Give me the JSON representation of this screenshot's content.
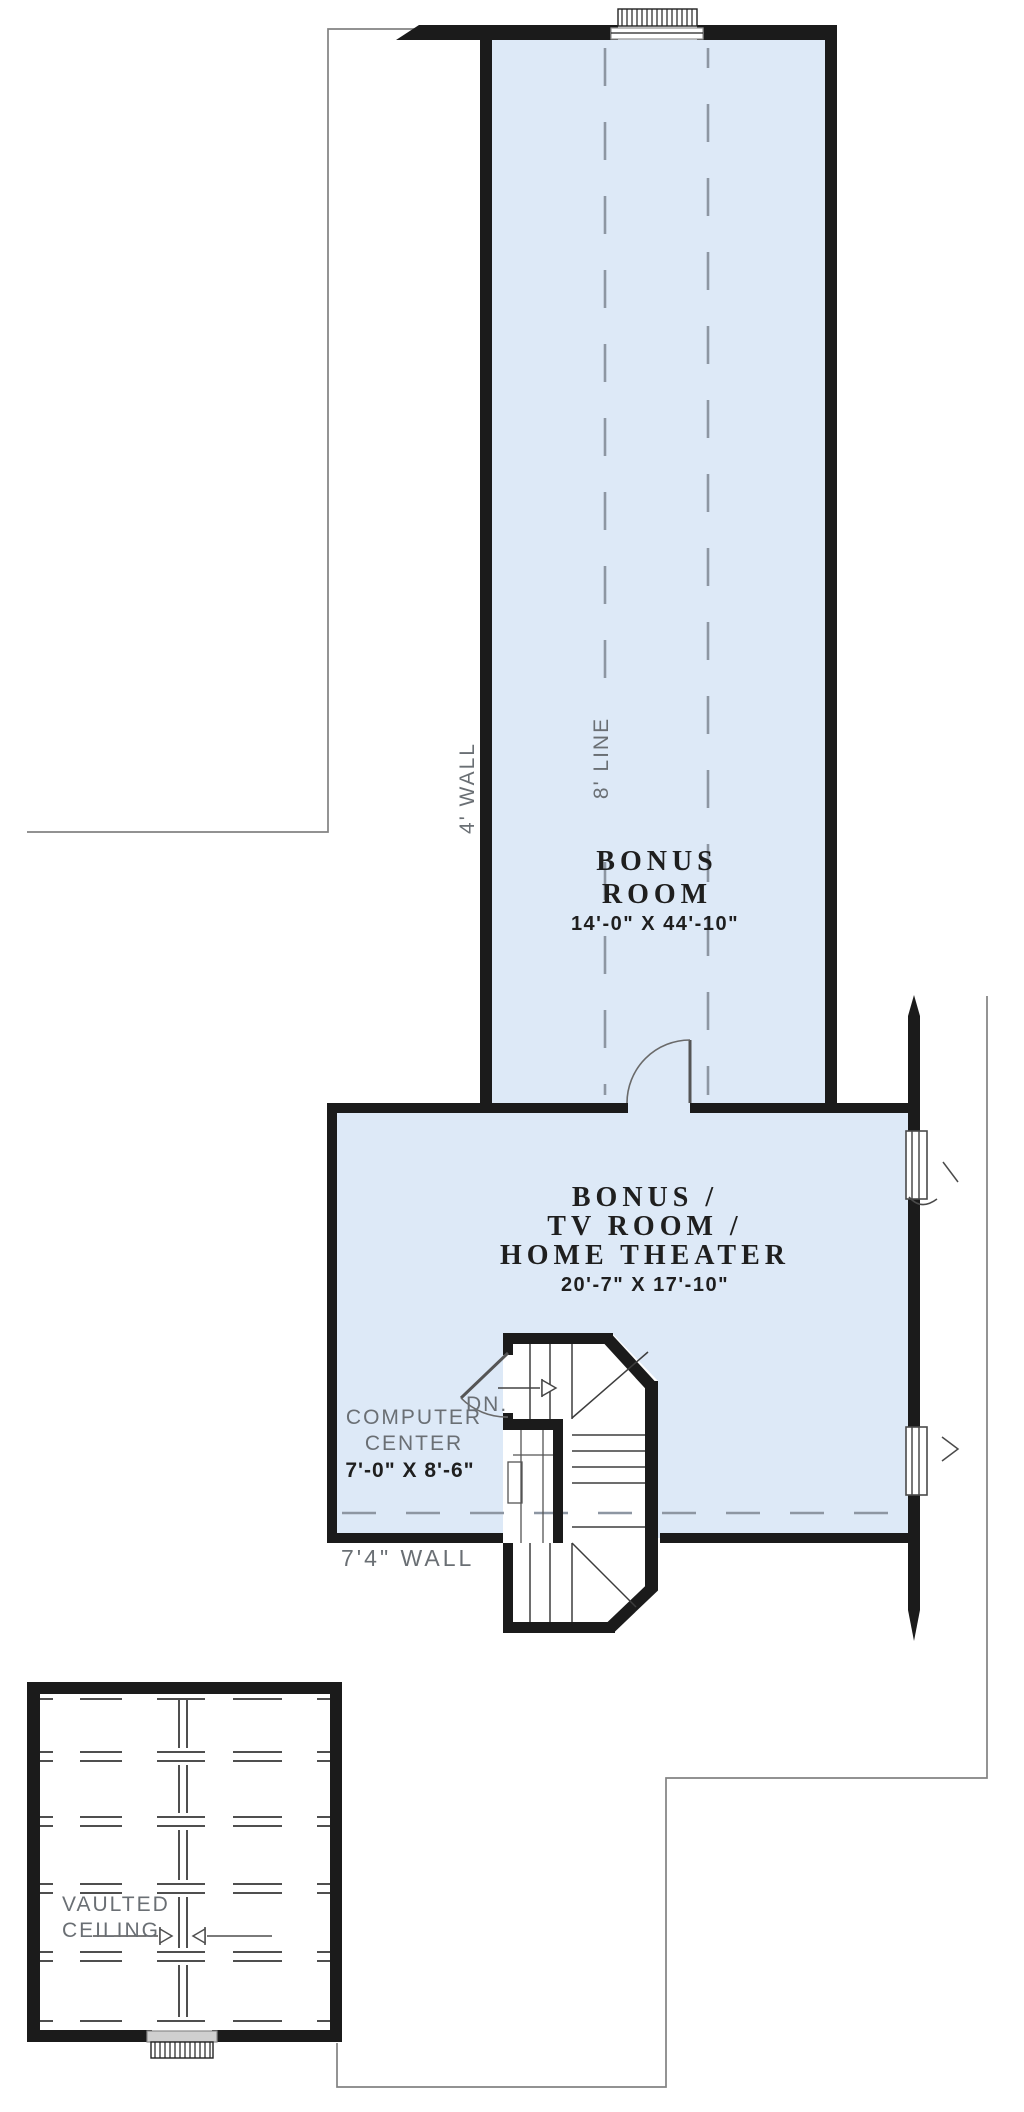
{
  "plan_title": "Bonus Room Floor Plan",
  "rooms": {
    "bonus": {
      "name": [
        "BONUS",
        "ROOM"
      ],
      "dims": "14'-0\" X 44'-10\""
    },
    "tv": {
      "name": [
        "BONUS /",
        "TV ROOM /",
        "HOME THEATER"
      ],
      "dims": "20'-7\" X 17'-10\""
    },
    "computer": {
      "name": [
        "COMPUTER",
        "CENTER"
      ],
      "dims": "7'-0\" X 8'-6\""
    },
    "vaulted": {
      "name": [
        "VAULTED",
        "CEILING"
      ]
    }
  },
  "annotations": {
    "wall4": "4' WALL",
    "line8": "8' LINE",
    "dn": "DN.",
    "wall74": "7'4\" WALL"
  },
  "colors": {
    "room_fill": "#dde9f7",
    "wall": "#1b1b1b",
    "roofline": "#828282",
    "dash": "#8d96a2",
    "label": "#6a6f74",
    "ink": "#1f1f1f"
  }
}
